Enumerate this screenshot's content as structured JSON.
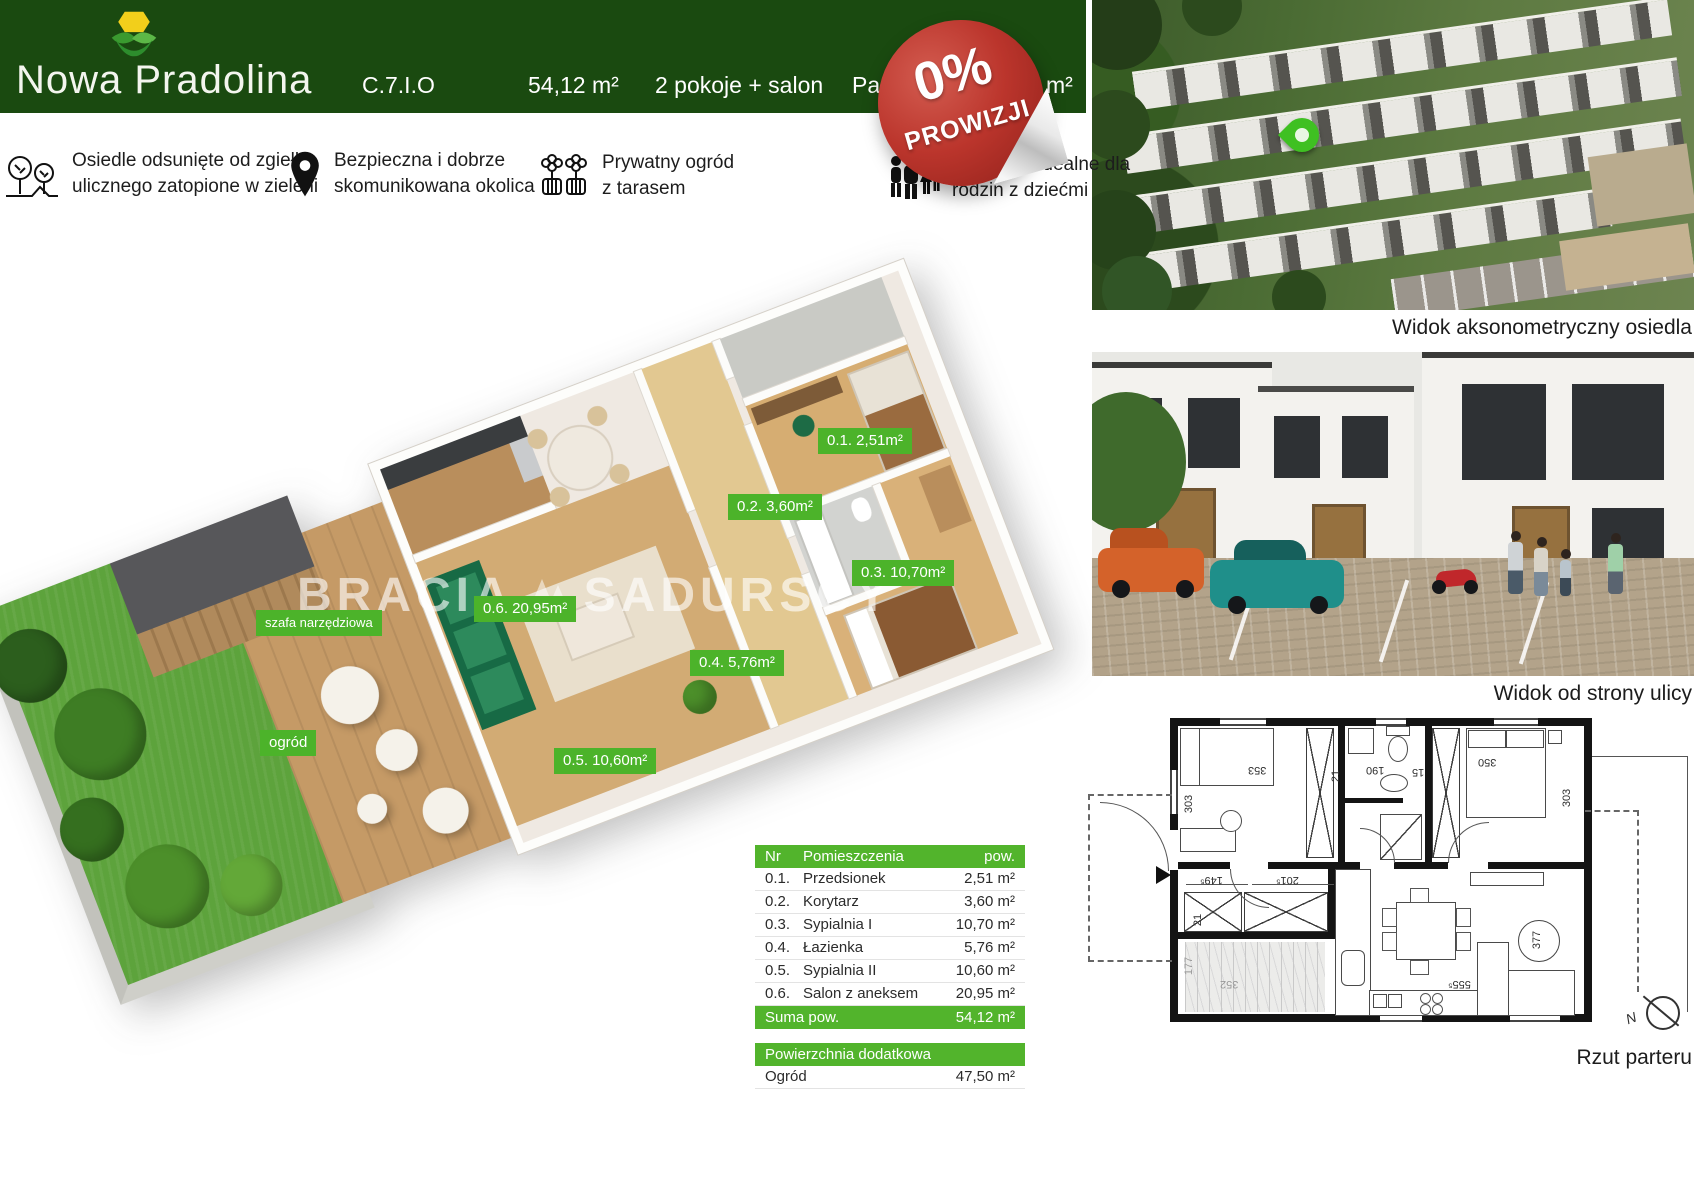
{
  "header": {
    "brand": "Nowa Pradolina",
    "unit_code": "C.7.I.O",
    "area": "54,12 m²",
    "layout": "2 pokoje + salon",
    "floor_fragment": "Pa",
    "right_fragment": "m²"
  },
  "badge": {
    "line1": "0%",
    "line2": "PROWIZJI"
  },
  "features": [
    {
      "icon": "trees-icon",
      "lines": [
        "Osiedle odsunięte od zgiełku",
        "ulicznego zatopione w zieleni"
      ]
    },
    {
      "icon": "location-pin-icon",
      "lines": [
        "Bezpieczna i dobrze",
        "skomunikowana okolica"
      ]
    },
    {
      "icon": "garden-icon",
      "lines": [
        "Prywatny ogród",
        "z tarasem"
      ]
    },
    {
      "icon": "family-icon",
      "lines": [
        "zkanie idealne dla",
        "rodzin z dziećmi"
      ]
    }
  ],
  "plan3d": {
    "watermark_left": "BRACIA",
    "watermark_right": "SADURSCY",
    "labels": {
      "l01": "0.1. 2,51m²",
      "l02": "0.2. 3,60m²",
      "l03": "0.3. 10,70m²",
      "l04": "0.4. 5,76m²",
      "l05": "0.5. 10,60m²",
      "l06": "0.6. 20,95m²",
      "shed": "szafa narzędziowa",
      "garden": "ogród"
    }
  },
  "table": {
    "col_nr": "Nr",
    "col_name": "Pomieszczenia",
    "col_area": "pow.",
    "rows": [
      {
        "nr": "0.1.",
        "name": "Przedsionek",
        "area": "2,51 m²"
      },
      {
        "nr": "0.2.",
        "name": "Korytarz",
        "area": "3,60 m²"
      },
      {
        "nr": "0.3.",
        "name": "Sypialnia I",
        "area": "10,70 m²"
      },
      {
        "nr": "0.4.",
        "name": "Łazienka",
        "area": "5,76 m²"
      },
      {
        "nr": "0.5.",
        "name": "Sypialnia II",
        "area": "10,60 m²"
      },
      {
        "nr": "0.6.",
        "name": "Salon z aneksem",
        "area": "20,95 m²"
      }
    ],
    "sum_label": "Suma pow.",
    "sum_value": "54,12 m²",
    "extra_title": "Powierzchnia dodatkowa",
    "extra_name": "Ogród",
    "extra_value": "47,50 m²"
  },
  "captions": {
    "aerial": "Widok aksonometryczny osiedla",
    "street": "Widok od strony ulicy",
    "plan": "Rzut parteru"
  },
  "tech": {
    "dims": [
      "353",
      "303",
      "21",
      "190",
      "15",
      "350",
      "303",
      "149⁵",
      "201⁵",
      "21",
      "177",
      "352",
      "555⁵",
      "377"
    ],
    "compass": "N"
  },
  "colors": {
    "header_green": "#1a4a10",
    "accent_green": "#4cb32a",
    "badge_red": "#bb352c"
  }
}
